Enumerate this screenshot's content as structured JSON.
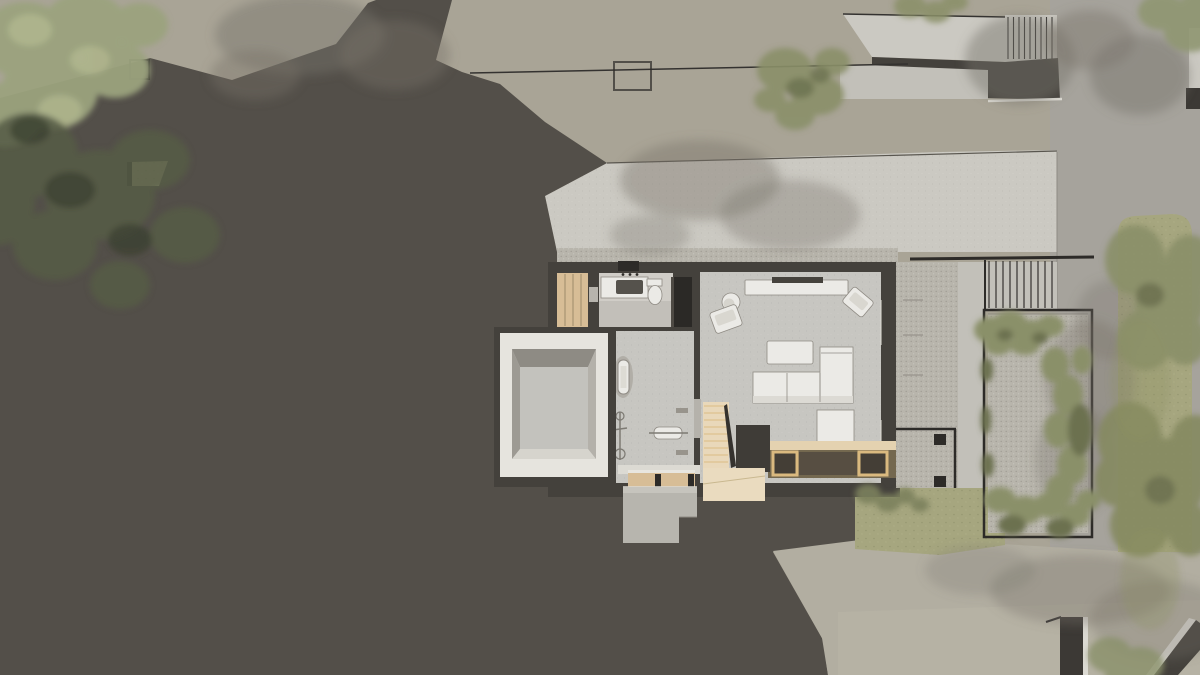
{
  "palette": {
    "bgBeige": "#a9a496",
    "bgGray": "#a6a39c",
    "shadow": "#534f49",
    "wall": "#44413c",
    "ink": "#2d2b28",
    "frameDark": "#343230",
    "concrete": "#cbc9c2",
    "concreteDim": "#c2c0b9",
    "white": "#ebeae6",
    "whiteDim": "#dcdad3",
    "floor": "#c7c6c1",
    "floorBright": "#d0cdc7",
    "gravel": "#b8b5ac",
    "road": "#b2aea1",
    "wood": "#d7bd96",
    "woodLight": "#e9d8ba",
    "woodDark": "#74684f",
    "woodFrame": "#dab97f",
    "grass": "#a6a67f",
    "grassPale": "#abaa86",
    "foliage": "#9ba37e",
    "foliageBright": "#b9bd94",
    "foliageDark": "#555c46",
    "foliageDeep": "#3b4232",
    "olive": "#8a9069",
    "oliveDark": "#6c7150",
    "shrub": "#7c815c",
    "treeShadow": "#78746a",
    "lineMid": "#8f8b84",
    "steel": "#7d7a73"
  },
  "scene": {
    "kind": "architectural-site-plan-render",
    "view": "top-down cutaway floor plan with site shadow",
    "areas": [
      "hillside-shadow",
      "upper-terrace",
      "terrace-gravel-edge",
      "neighbor-entry-stair",
      "main-house",
      "gravel-side-path",
      "side-gate",
      "courtyard-garden",
      "pergola-rails",
      "right-lawn",
      "driveway",
      "street-pillar",
      "corner-wall",
      "lawn-cutout",
      "skylight-frames"
    ],
    "house_rooms": [
      "closet",
      "bathroom",
      "living-room",
      "sunken-courtyard",
      "gym",
      "stair-hall",
      "entry-porch"
    ],
    "bathroom_fixtures": [
      "vanity-counter",
      "sink",
      "faucet",
      "toilet",
      "wardrobe"
    ],
    "living_room_furniture": [
      "tv-console",
      "tv",
      "round-side-table",
      "armchair-left",
      "armchair-corner",
      "coffee-table",
      "sectional-sofa",
      "lounge-cushion",
      "daybed-platform"
    ],
    "gym_equipment": [
      "treadmill",
      "exercise-bike",
      "workout-bench",
      "wall-rack"
    ],
    "stair_parts": [
      "wood-treads",
      "railing",
      "landing"
    ],
    "entry_parts": [
      "threshold",
      "drawer-bench",
      "concrete-steps"
    ]
  }
}
